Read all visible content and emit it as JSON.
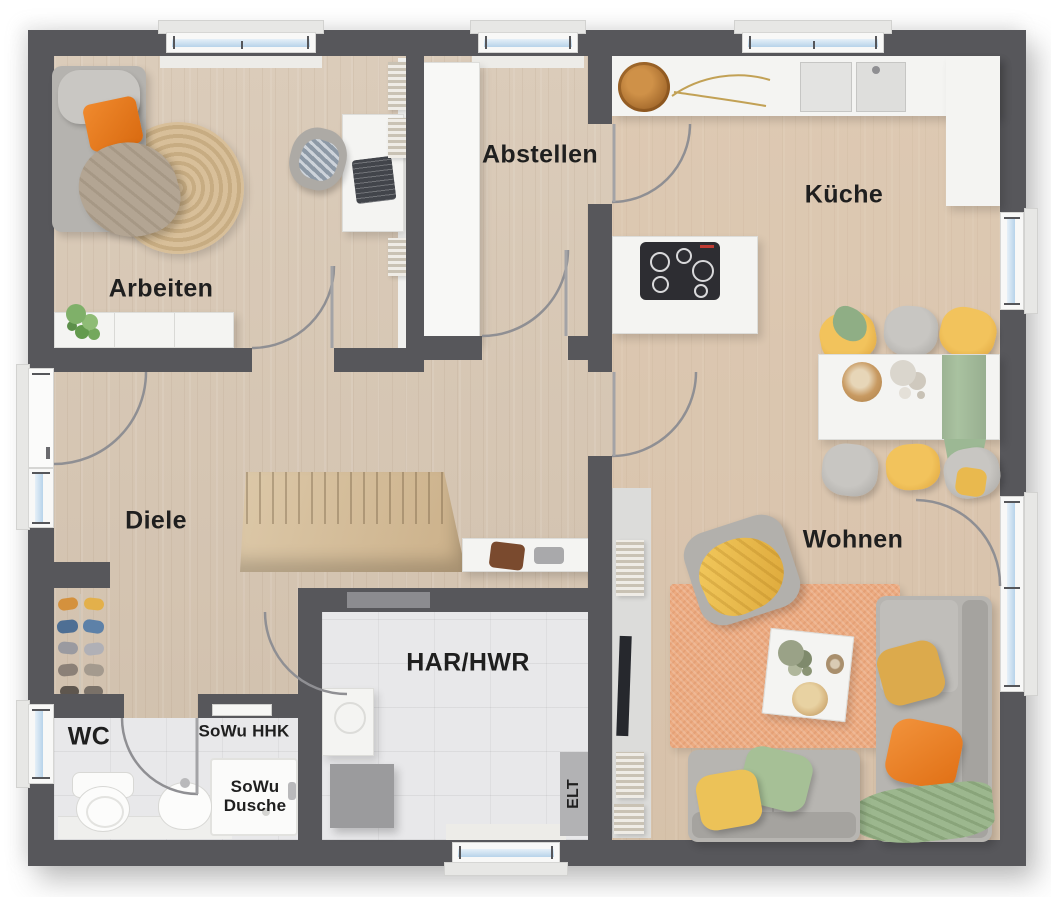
{
  "floorplan": {
    "rooms": [
      {
        "id": "arbeiten",
        "label": "Arbeiten"
      },
      {
        "id": "abstellen",
        "label": "Abstellen"
      },
      {
        "id": "kueche",
        "label": "Küche"
      },
      {
        "id": "diele",
        "label": "Diele"
      },
      {
        "id": "wohnen",
        "label": "Wohnen"
      },
      {
        "id": "wc",
        "label": "WC"
      },
      {
        "id": "har-hwr",
        "label": "HAR/HWR"
      },
      {
        "id": "sowu-hhk",
        "label": "SoWu HHK"
      },
      {
        "id": "sowu-dusche",
        "label": "SoWu Dusche"
      },
      {
        "id": "elt",
        "label": "ELT"
      }
    ],
    "colors": {
      "wall": "#57575b",
      "wood_floor": "#d7c6b2",
      "kitchen_wood_tint": "#e4c4a6",
      "tile_floor": "#e8e8ea",
      "stairs_wood": "#d6bf9e",
      "living_rug": "#ecab81",
      "office_rug": "#d2b992",
      "accent_orange": "#e87722",
      "accent_yellow": "#edbb4e",
      "accent_green": "#9cb48c",
      "window_glass": "#b7d3ea"
    }
  }
}
